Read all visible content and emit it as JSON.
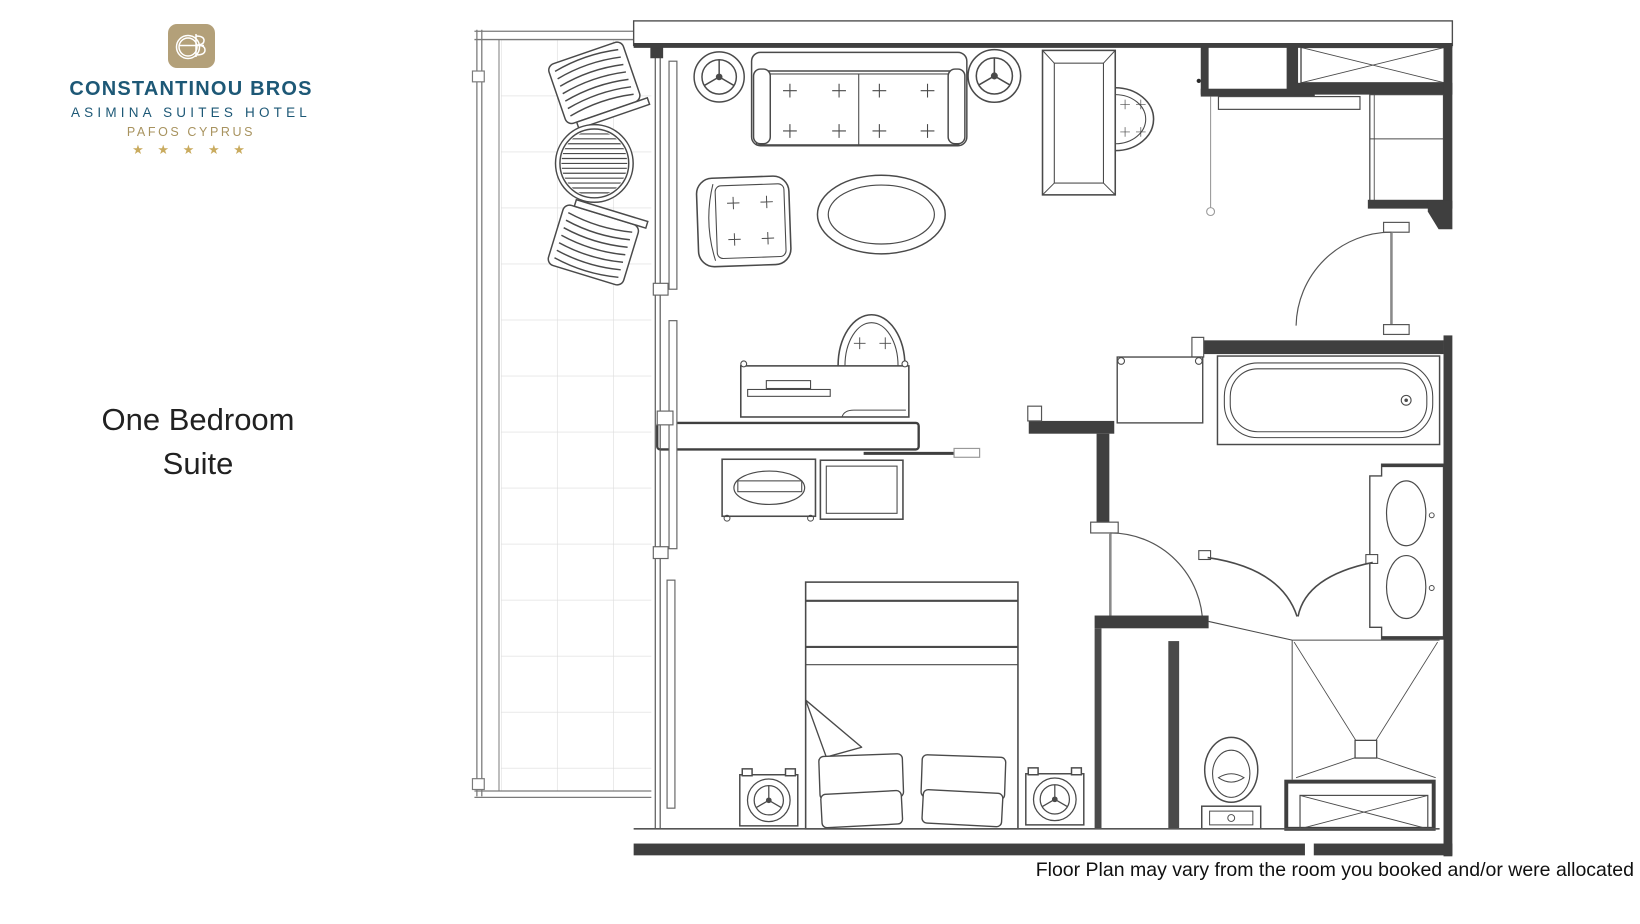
{
  "branding": {
    "monogram": "CB",
    "name": "CONSTANTINOU BROS",
    "subtitle": "ASIMINA SUITES HOTEL",
    "location": "PAFOS CYPRUS",
    "stars": "★ ★ ★ ★ ★",
    "colors": {
      "gold": "#b3a079",
      "blue": "#1d5876",
      "star_gold": "#c9ab5f"
    }
  },
  "page": {
    "title_line1": "One Bedroom",
    "title_line2": "Suite",
    "disclaimer": "Floor Plan may vary from the room you booked and/or were allocated",
    "background": "#ffffff"
  },
  "floor_plan": {
    "room_type": "One Bedroom Suite",
    "colors": {
      "wall": "#3f3f3f",
      "line": "#4a4a4a",
      "tile_grid": "#dcdcdc"
    },
    "areas": [
      "balcony",
      "living-room",
      "bedroom",
      "entrance-hall",
      "bathroom",
      "shower",
      "toilet-nook"
    ],
    "furniture": [
      "lounge-chair",
      "lounge-chair",
      "round-slat-table",
      "ceiling-speaker",
      "ceiling-speaker",
      "two-seat-sofa",
      "armchair",
      "oval-coffee-table",
      "dining-table",
      "dining-chair",
      "desk",
      "desk-chair",
      "tv-partition",
      "dresser",
      "stool",
      "double-bed",
      "pillows",
      "nightstand-lamp",
      "nightstand-lamp",
      "entrance-closet",
      "wardrobe-xbox",
      "hanging-rod",
      "wall-closet",
      "luggage-rack",
      "bathtub",
      "double-vanity",
      "toilet",
      "curved-shower-doors",
      "shower-drain",
      "storage-xbox"
    ]
  }
}
